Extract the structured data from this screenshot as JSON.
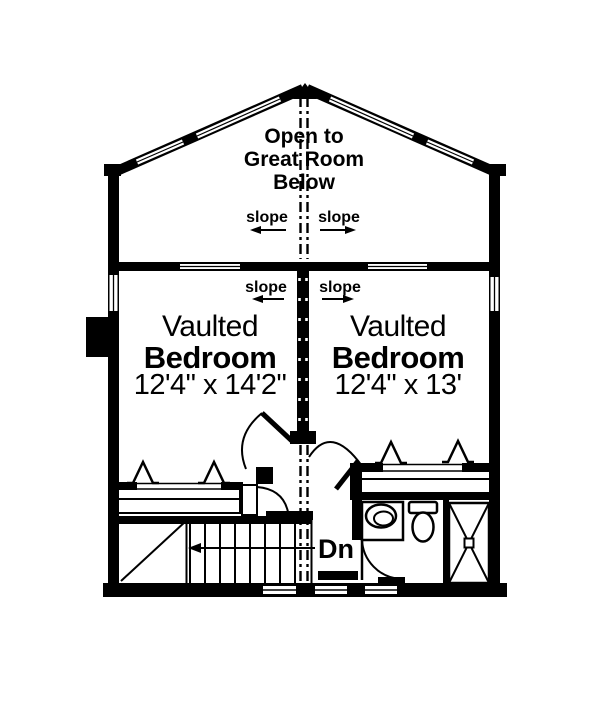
{
  "plan": {
    "open_area": {
      "label_line1": "Open to",
      "label_line2": "Great Room",
      "label_line3": "Below"
    },
    "slope_label": "slope",
    "stairs": {
      "direction_label": "Dn"
    },
    "bedroom_left": {
      "name_line1": "Vaulted",
      "name_line2": "Bedroom",
      "dimensions": "12'4\" x 14'2\""
    },
    "bedroom_right": {
      "name_line1": "Vaulted",
      "name_line2": "Bedroom",
      "dimensions": "12'4\" x 13'"
    },
    "colors": {
      "ink": "#000000",
      "paper": "#ffffff"
    }
  }
}
